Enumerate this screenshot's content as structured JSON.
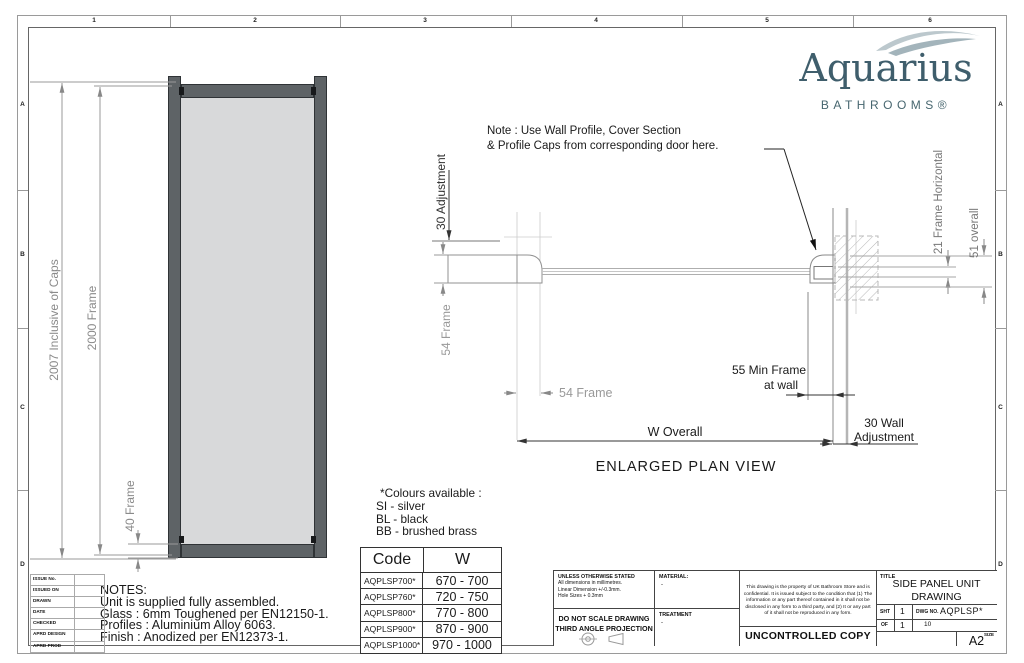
{
  "border": {
    "columns": [
      "1",
      "2",
      "3",
      "4",
      "5",
      "6"
    ],
    "rows": [
      "A",
      "B",
      "C",
      "D"
    ]
  },
  "logo": {
    "name": "Aquarius",
    "subtitle": "BATHROOMS®"
  },
  "elevation": {
    "dim_total": "2007 Inclusive of Caps",
    "dim_frame": "2000 Frame",
    "dim_bottom": "40 Frame"
  },
  "plan": {
    "note_line1": "Note : Use Wall Profile, Cover Section",
    "note_line2": "& Profile Caps from corresponding door here.",
    "dim_adjustment": "30 Adjustment",
    "dim_frame_depth": "54 Frame",
    "dim_frame_width": "54 Frame",
    "dim_min_frame_line1": "55 Min Frame",
    "dim_min_frame_line2": "at wall",
    "dim_w_overall": "W Overall",
    "dim_wall_adj_line1": "30 Wall",
    "dim_wall_adj_line2": "Adjustment",
    "dim_frame_horizontal": "21 Frame Horizontal",
    "dim_overall": "51 overall",
    "caption": "ENLARGED PLAN VIEW"
  },
  "colours": {
    "title": "*Colours available :",
    "items": [
      "SI - silver",
      "BL - black",
      "BB - brushed brass"
    ]
  },
  "size_table": {
    "col_code": "Code",
    "col_w": "W",
    "rows": [
      {
        "code": "AQPLSP700*",
        "w": "670 - 700"
      },
      {
        "code": "AQPLSP760*",
        "w": "720 - 750"
      },
      {
        "code": "AQPLSP800*",
        "w": "770 - 800"
      },
      {
        "code": "AQPLSP900*",
        "w": "870 - 900"
      },
      {
        "code": "AQPLSP1000*",
        "w": "970 - 1000"
      }
    ]
  },
  "notes": {
    "title": "NOTES:",
    "lines": [
      "Unit is supplied fully assembled.",
      "Glass : 6mm Toughened per EN12150-1.",
      "Profiles : Aluminium Alloy 6063.",
      "Finish : Anodized per EN12373-1."
    ]
  },
  "issue_table": {
    "labels": [
      "ISSUE No.",
      "ISSUED ON",
      "DRAWN",
      "DATE",
      "CHECKED",
      "APRD DESIGN",
      "APRD PROD"
    ]
  },
  "title_block": {
    "tol_line1": "UNLESS OTHERWISE STATED",
    "tol_line2": "All dimensions in millimetres.",
    "tol_line3": "Linear Dimension +/-0.3mm.",
    "tol_line4": "Hole Sizes + 0.3mm",
    "material_label": "MATERIAL:",
    "material_value": "-",
    "treatment_label": "TREATMENT",
    "treatment_value": "-",
    "do_not_scale": "DO NOT SCALE DRAWING",
    "projection": "THIRD ANGLE PROJECTION",
    "confidential": "This drawing is the property of UK Bathroom Store and is confidential. It is issued subject to the condition that (1) The information or any part thereof contained in it shall not be disclosed in any form to a third party, and (2) It or any part of it shall not be reproduced in any form.",
    "uncontrolled": "UNCONTROLLED COPY",
    "title_label": "TITLE",
    "title_line1": "SIDE PANEL UNIT",
    "title_line2": "DRAWING",
    "sht_label": "SHT",
    "sht_value": "1",
    "of_label": "OF",
    "of_value": "1",
    "dwg_label": "DWG NO.",
    "dwg_value": "AQPLSP*",
    "issue_no": "10",
    "size_label": "SIZE",
    "size_value": "A2"
  },
  "colors": {
    "logo": "#3f5e6c",
    "frame": "#5e6366",
    "glass": "#d8d9da"
  }
}
